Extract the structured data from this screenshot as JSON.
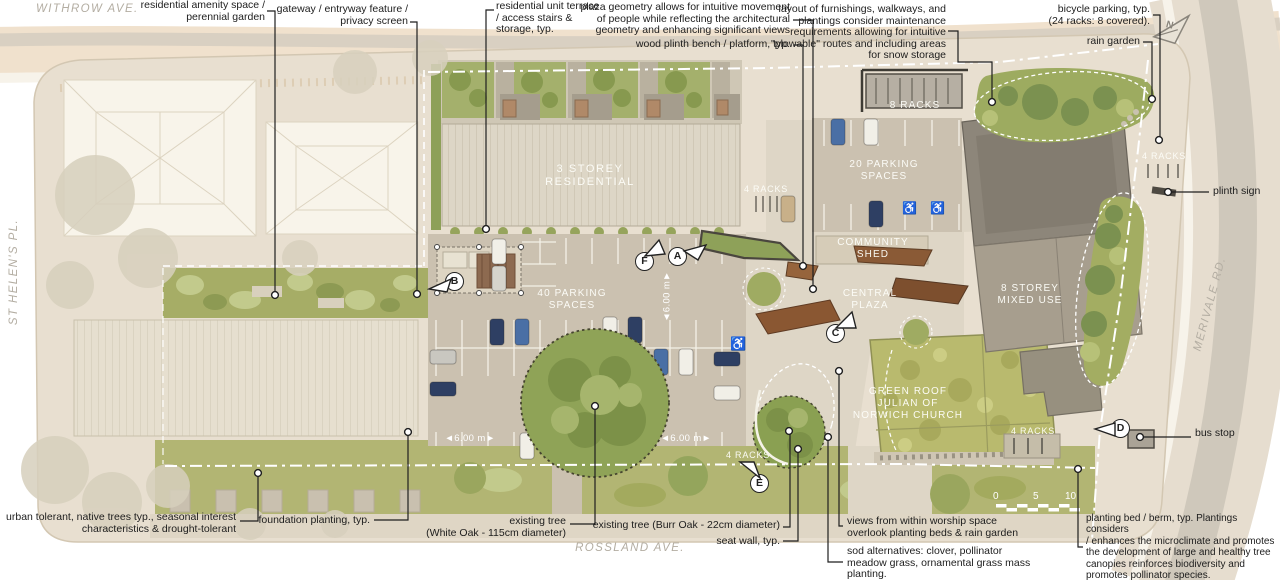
{
  "palette": {
    "page": "#ffffff",
    "site": "#e8dfd0",
    "road-top": "#f0e1cd",
    "road-gray": "#cfc8bb",
    "sidewalk": "#f7f3ea",
    "asphalt": "#cbc1b0",
    "plaza": "#ded6c6",
    "roof-ribbed": "#ddd6c6",
    "roof-context": "#f8f4ea",
    "roof-dark": "#8d867a",
    "roof-mid": "#a79e8e",
    "green-roof": "#b9ba6e",
    "garden": "#a6ad66",
    "lawn": "#b2b573",
    "tree": "#8fa357",
    "tree-dark": "#7b9150",
    "tree-faded": "#d7d0bd",
    "bench": "#8a5a36",
    "ink": "#1f1f1f",
    "street-text": "#b3ada2"
  },
  "streets": {
    "top": "WITHROW AVE.",
    "left": "ST HELEN'S PL.",
    "right": "MERIVALE RD.",
    "bottom": "ROSSLAND AVE."
  },
  "north_label": "N",
  "annotations": {
    "amenity": "residential amenity space /\nperennial garden",
    "gateway": "gateway / entryway feature /\nprivacy screen",
    "terrace": "residential unit terrace\n/ access stairs &\nstorage, typ.",
    "plaza_geometry": "plaza geometry allows for intuitive movement\nof people while reflecting the architectural\ngeometry and enhancing significant views",
    "bench": "wood plinth bench / platform, typ.",
    "furnishings": "layout of furnishings, walkways, and\nplantings consider maintenance\nrequirements allowing for intuitive\n\"plowable\" routes and including areas\nfor snow storage",
    "bicycle": "bicycle parking, typ.\n(24 racks: 8 covered).",
    "rain_garden": "rain garden",
    "plinth_sign": "plinth sign",
    "bus_stop": "bus stop",
    "urban_trees": "urban tolerant, native trees typ., seasonal interest\ncharacteristics & drought-tolerant",
    "foundation": "foundation planting, typ.",
    "white_oak": "existing tree\n(White Oak - 115cm diameter)",
    "burr_oak": "existing tree (Burr Oak - 22cm diameter)",
    "seat_wall": "seat wall, typ.",
    "worship_views": "views from within worship space\noverlook planting beds & rain garden",
    "sod": "sod alternatives: clover, pollinator\nmeadow grass, ornamental grass mass\nplanting.",
    "berm": "planting bed / berm, typ. Plantings considers\n/ enhances the microclimate and promotes\nthe development of large and healthy tree\ncanopies reinforces biodiversity and\npromotes pollinator species."
  },
  "plan_labels": {
    "residential3": "3 STOREY\nRESIDENTIAL",
    "parking40": "40 PARKING\nSPACES",
    "parking20": "20 PARKING\nSPACES",
    "racks8": "8 RACKS",
    "racks4_plaza": "4 RACKS",
    "racks4_east": "4 RACKS",
    "racks4_south": "4 RACKS",
    "racks4_se": "4 RACKS",
    "community_shed": "COMMUNITY\nSHED",
    "central_plaza": "CENTRAL\nPLAZA",
    "mixed_use": "8 STOREY\nMIXED USE",
    "church": "GREEN ROOF\nJULIAN OF\nNORWICH CHURCH"
  },
  "dimensions": {
    "value": "6.00 m",
    "arrow_left": "◄",
    "arrow_right": "►"
  },
  "scale_bar": {
    "t0": "0",
    "t5": "5",
    "t10": "10"
  },
  "markers": {
    "a": "A",
    "b": "B",
    "c": "C",
    "d": "D",
    "e": "E",
    "f": "F"
  }
}
